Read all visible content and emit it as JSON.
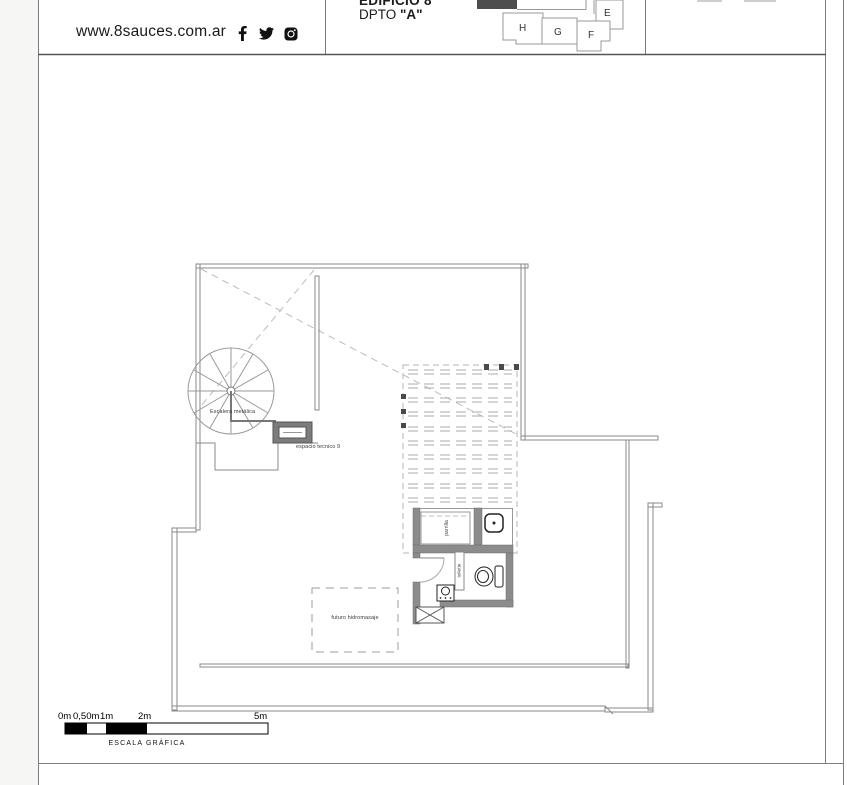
{
  "header": {
    "website": "www.8sauces.com.ar",
    "building": "EDIFICIO 8",
    "unit_prefix": "DPTO",
    "unit_name": "\"A\"",
    "keyplan_units": [
      "E",
      "H",
      "G",
      "F"
    ],
    "social": [
      "facebook",
      "twitter",
      "instagram"
    ]
  },
  "icons": {
    "facebook_glyph": "f"
  },
  "plan": {
    "stair_label": "Escalera metálica",
    "tech_space_label": "espacio tecnico 9",
    "grill_label": "parrilla",
    "toilette_label": "toilette",
    "future_jacuzzi_label": "futuro hidromasaje"
  },
  "scale_bar": {
    "ticks": [
      "0m",
      "0,50m",
      "1m",
      "2m",
      "5m"
    ],
    "caption": "ESCALA GRÁFICA"
  },
  "colors": {
    "wall": "#8c8c8c",
    "line": "#8a8a8a",
    "highlight": "#4d4d4d"
  }
}
